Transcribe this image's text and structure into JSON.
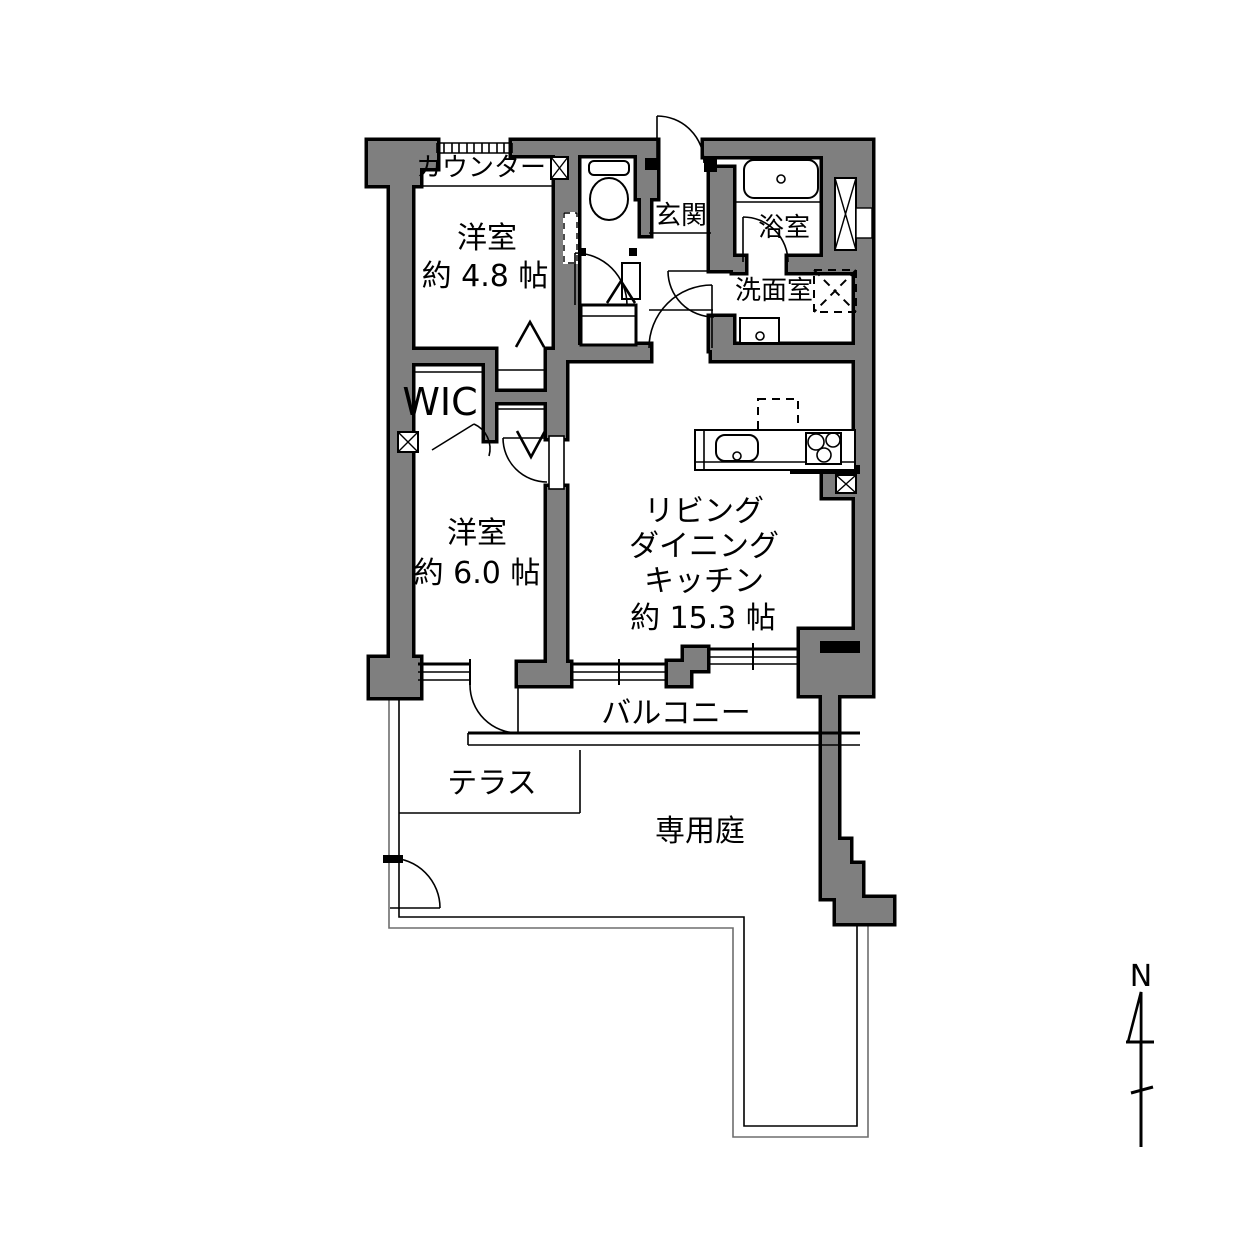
{
  "title": "apartment-floorplan",
  "colors": {
    "wall": "#7f7f7f",
    "outline": "#000000",
    "background": "#ffffff",
    "fence_outer": "#6e6e6e"
  },
  "labels": {
    "counter": "カウンター",
    "room1_name": "洋室",
    "room1_size": "約 4.8 帖",
    "entrance": "玄関",
    "bath": "浴室",
    "washroom": "洗面室",
    "wic": "WIC",
    "room2_name": "洋室",
    "room2_size": "約 6.0 帖",
    "ldk_line1": "リビング",
    "ldk_line2": "ダイニング",
    "ldk_line3": "キッチン",
    "ldk_size": "約 15.3 帖",
    "balcony": "バルコニー",
    "terrace": "テラス",
    "garden": "専用庭",
    "north": "N"
  }
}
